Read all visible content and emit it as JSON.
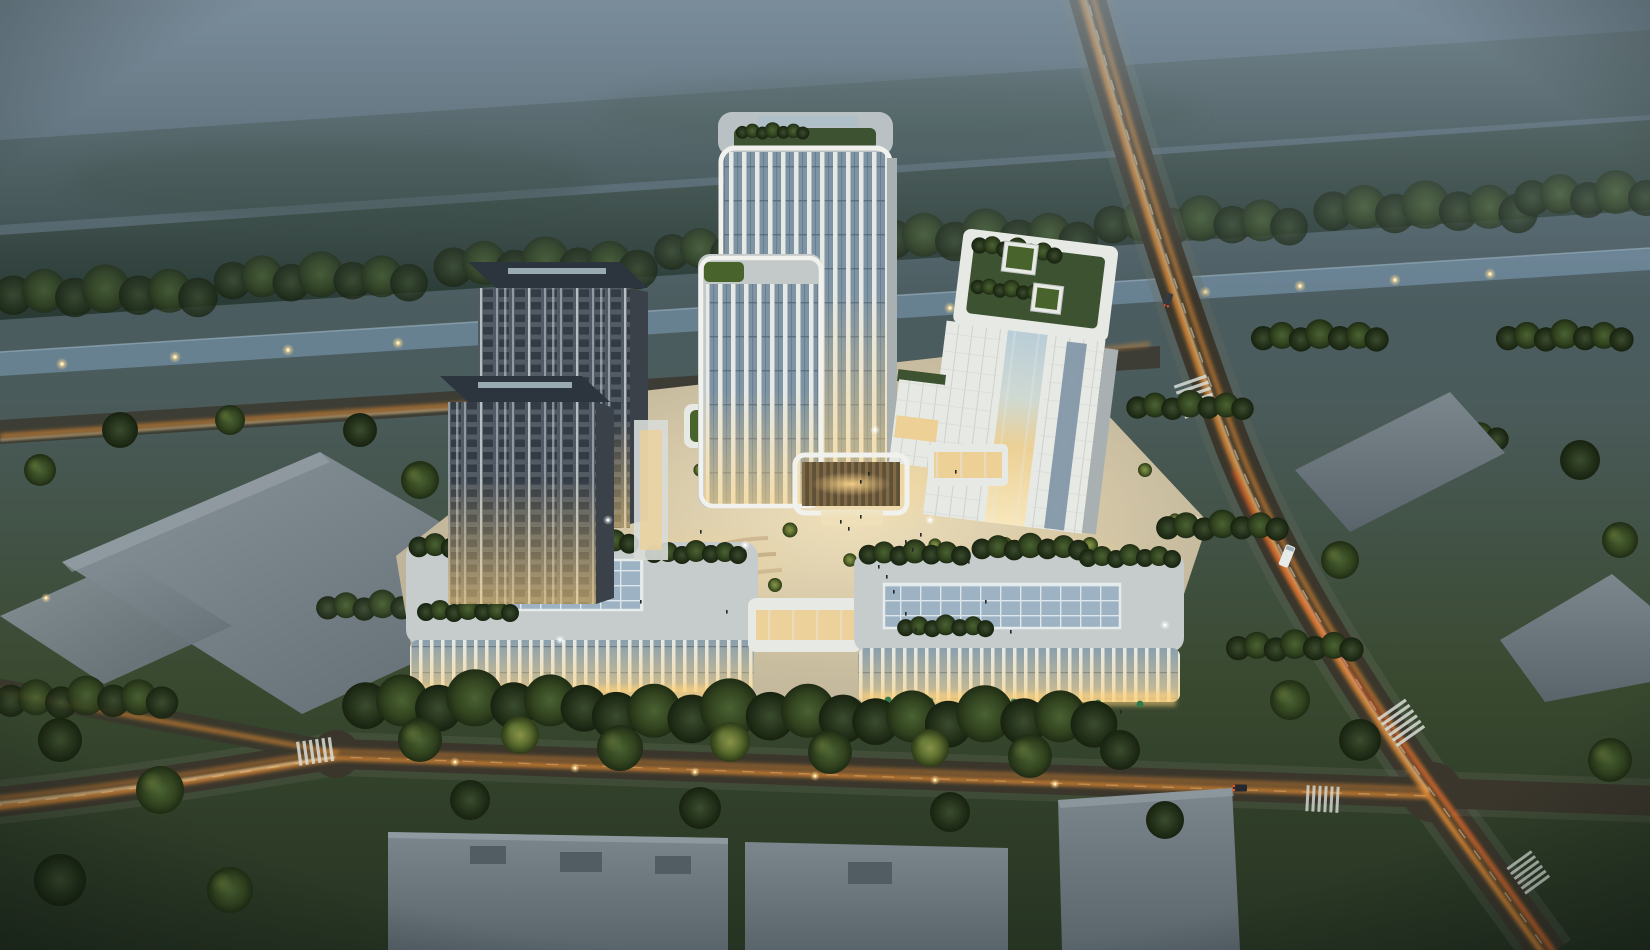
{
  "scene": {
    "name": "aerial-dusk-rendering-mixed-use-campus",
    "view": "aerial-oblique",
    "time_of_day": "dusk"
  },
  "inventory": {
    "high_rise_towers": 4,
    "office_slab_buildings": 1,
    "retail_podiums": 2,
    "sky_bridges": 2,
    "entrance_canopies": 1,
    "rooftop_gardens": 6,
    "warehouse_blocks": 7,
    "road_intersections": 2,
    "crosswalks": 5,
    "canals": 1,
    "central_plazas": 1
  },
  "palette": {
    "skyTop": "#506271",
    "skyMid": "#4a5b5b",
    "skyLow": "#39492f",
    "ground": "#263322",
    "mist": "#9db0bd",
    "forestBand": "#31423a",
    "forestBandDark": "#263731",
    "canal": "#6a8496",
    "canalEdge": "#93aab8",
    "lampGlow": "#ffd98c",
    "lampCore": "#ffedc0",
    "roadDark": "#3a362c",
    "roadEdge": "#686c5c",
    "trailOrange": "#ff9a36",
    "trailHot": "#ffe2ac",
    "trailRed": "#ff5222",
    "laneWhite": "#d9ded8",
    "pave": "#c9bda0",
    "paveBright": "#efe0ba",
    "pedestal": "#b4ab93",
    "glowWarm": "#ffd27a",
    "towerWhite": "#e7e9e4",
    "towerFrame": "#f1f2ee",
    "sideShade": "#a9b0b1",
    "sideDark": "#3a4149",
    "glassCool": "#7e94a5",
    "glassDeep": "#54687a",
    "glassWarm": "#ecd096",
    "darkFacade": "#525a63",
    "darkWin": "#333b45",
    "mullion": "#97a1aa",
    "litWin": "#d8ae6e",
    "roofDark": "#2c343d",
    "roofStrip": "#aebfc7",
    "roofLight": "#c6cccb",
    "garden": "#3c5230",
    "gardenHi": "#49632c",
    "skylight": "#9db2c2",
    "skylightLine": "#dde6ea",
    "whRoof": "#747e83",
    "whRoofB": "#68737a",
    "whSide": "#4f575c",
    "whNotch": "#515c63",
    "umbrella": "#2f7a4a",
    "people": "#23262b",
    "canopyRoof": "#5f5038",
    "canopySlat": "#8a6f4a"
  }
}
